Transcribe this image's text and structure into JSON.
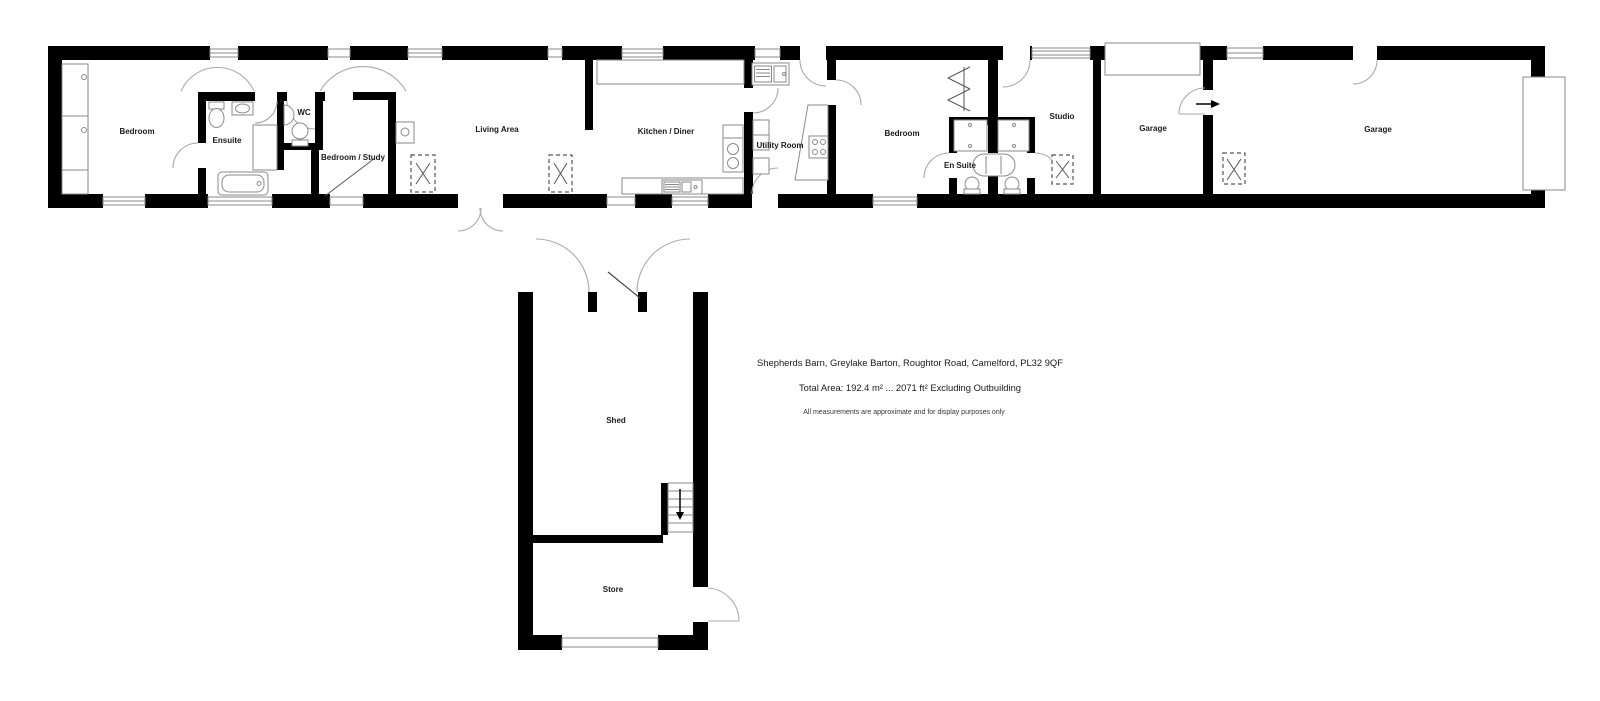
{
  "labels": {
    "bedroom1": "Bedroom",
    "ensuite1": "Ensuite",
    "wc": "WC",
    "bedroom_study": "Bedroom / Study",
    "living_area": "Living Area",
    "kitchen_diner": "Kitchen / Diner",
    "utility_room": "Utility Room",
    "bedroom2": "Bedroom",
    "ensuite2": "En Suite",
    "studio": "Studio",
    "garage1": "Garage",
    "garage2": "Garage",
    "shed": "Shed",
    "store": "Store"
  },
  "footer": {
    "address": "Shepherds Barn, Greylake Barton, Roughtor Road, Camelford, PL32 9QF",
    "total_area": "Total Area: 192.4 m² ... 2071 ft² Excluding Outbuilding",
    "disclaimer": "All measurements are approximate and for display purposes only"
  },
  "colors": {
    "wall": "#000000",
    "fixture_line": "#8a8a8a",
    "door_arc": "#aaaaaa",
    "text": "#1a1a1a",
    "background": "#ffffff"
  }
}
